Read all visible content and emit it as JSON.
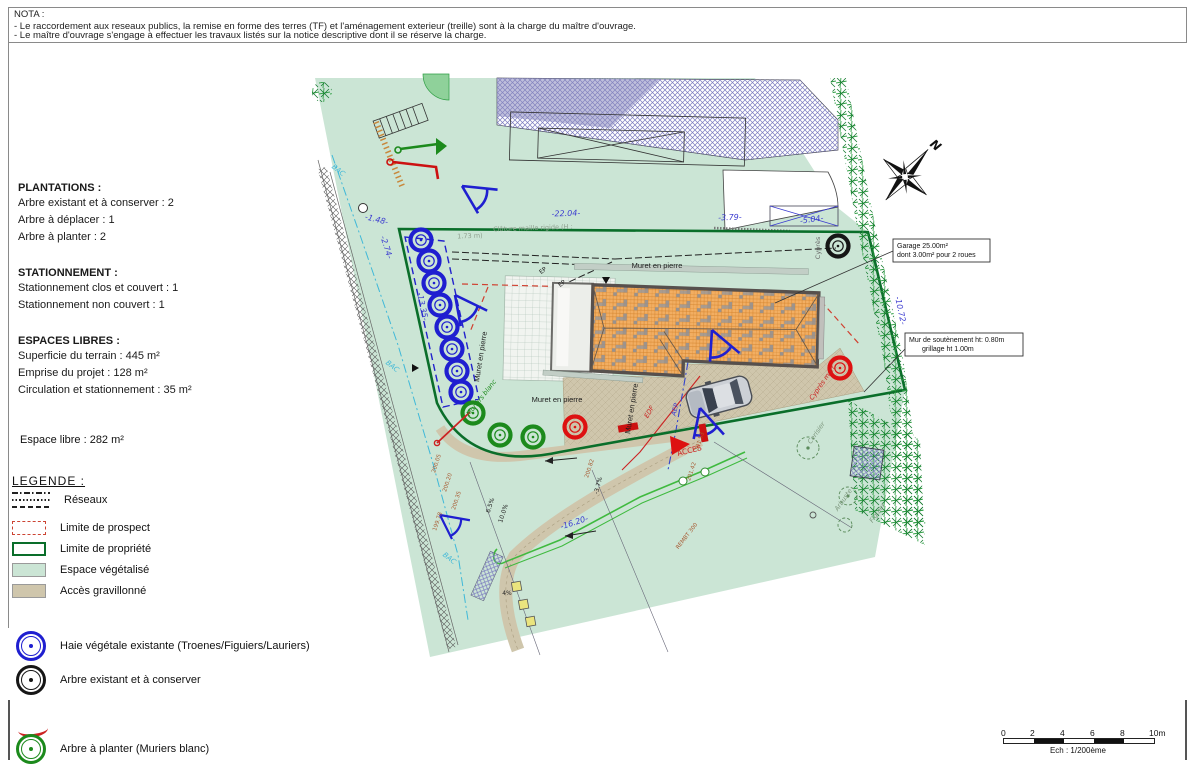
{
  "nota": {
    "title": "NOTA :",
    "line1": "- Le raccordement aux reseaux publics, la remise en forme des terres (TF) et l'aménagement exterieur (treille) sont à la charge du maître d'ouvrage.",
    "line2": "- Le maître d'ouvrage s'engage à effectuer les travaux listés sur la notice descriptive dont il se réserve la charge."
  },
  "info": {
    "plantations_title": "PLANTATIONS :",
    "plantations": [
      "Arbre existant et à conserver : 2",
      "Arbre à déplacer : 1",
      "Arbre à planter : 2"
    ],
    "stationnement_title": "STATIONNEMENT :",
    "stationnement": [
      "Stationnement clos et couvert : 1",
      "Stationnement non couvert : 1"
    ],
    "espaces_title": "ESPACES LIBRES :",
    "espaces": [
      "Superficie du terrain : 445 m²",
      "Emprise du projet : 128 m²",
      "Circulation et stationnement : 35 m²"
    ],
    "espace_libre": "Espace libre : 282 m²"
  },
  "legend": {
    "title": "LEGENDE :",
    "reseaux": "Réseaux",
    "prospect": "Limite de prospect",
    "propriete": "Limite de propriété",
    "vegetalise": "Espace végétalisé",
    "gravillonne": "Accès gravillonné",
    "haie": "Haie végétale existante (Troenes/Figuiers/Lauriers)",
    "arbre_existant": "Arbre existant et à conserver",
    "arbre_planter": "Arbre à planter (Muriers blanc)"
  },
  "callouts": {
    "garage_l1": "Garage 25.00m²",
    "garage_l2": "dont 3.00m² pour 2 roues",
    "mur_l1": "Mur de soutènement ht: 0.80m",
    "mur_l2": "grillage ht 1.00m"
  },
  "compass_n": "N",
  "scalebar": {
    "t0": "0",
    "t1": "2",
    "t2": "4",
    "t3": "6",
    "t4": "8",
    "t5": "10m",
    "caption": "Ech : 1/200ème"
  },
  "map_labels": [
    "-22.04-",
    "-3.79-",
    "-5.04-",
    "-1.48-",
    "-2.74-",
    "-13.35-",
    "-10.72-",
    "-16.20-",
    "-3.7%",
    "6.5%",
    "10.0%",
    "Clôture maille rigide (H :",
    "1.73 m)",
    "Muret en pierre",
    "Muret en pierre",
    "Muret en pierre",
    "Muret en pierre",
    "EP",
    "EP",
    "EDF",
    "AEP",
    "ACCES",
    "BAC",
    "BAC",
    "BAC",
    "Cyprès",
    "Cyprès mort",
    "Cerisier",
    "Arbuste",
    "Figuier",
    "Muriers blanc",
    "200.05",
    "200.20",
    "200.35",
    "200.82",
    "201.53",
    "201.42",
    "199.78",
    "REMBT 300",
    "4%"
  ],
  "colors": {
    "vegetated": "#cbe5d5",
    "gravel": "#cfc6ac",
    "property_line": "#0a6e2a",
    "prospect_red": "#cc4433",
    "hedge_blue": "#1f1fd0",
    "plant_green": "#1c8a1c",
    "move_red": "#dd1111",
    "dimension_blue": "#3b3bd0",
    "roof_orange": "#f2ae62"
  }
}
